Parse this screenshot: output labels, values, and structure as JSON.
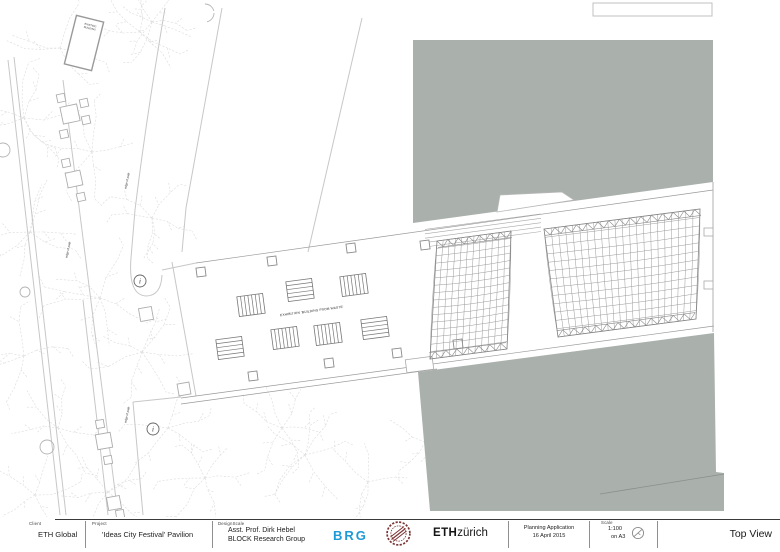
{
  "titleblock": {
    "client_label": "Client",
    "client_value": "ETH Global",
    "project_label": "Project",
    "project_value": "'Ideas City Festival' Pavilion",
    "design_label": "DesignScale",
    "design_line1": "Asst. Prof. Dirk Hebel",
    "design_line2": "BLOCK Research Group",
    "brg_logo": "BRG",
    "eth_bold": "ETH",
    "eth_light": "zürich",
    "planning_line1": "Planning Application",
    "planning_line2": "16 April 2015",
    "scale_label": "Scale",
    "scale_value": "1:100",
    "scale_sheet": "on A3",
    "view_title": "Top View"
  },
  "colors": {
    "block_gray": "#aab0ac",
    "line_light": "#c7c7c7",
    "line_mid": "#9a9a9a",
    "tree": "#dcdcdc",
    "brg_blue": "#1e9ad6",
    "stamp_red": "#7a3434"
  },
  "drawing": {
    "labels": {
      "exhibition": "EXHIBITION 'BUILDING FROM WASTE'",
      "path_label": "edge of path",
      "existing_note": [
        "EXISTING",
        "BUILDING"
      ],
      "marker_glyph": "i"
    },
    "gray_top_poly": [
      [
        413,
        40
      ],
      [
        713,
        40
      ],
      [
        713,
        182
      ],
      [
        413,
        223
      ]
    ],
    "gray_top_notch": [
      [
        497,
        212
      ],
      [
        500,
        195
      ],
      [
        562,
        192
      ],
      [
        574,
        200
      ]
    ],
    "gray_bottom_poly": [
      [
        418,
        372
      ],
      [
        714,
        333
      ],
      [
        716,
        472
      ],
      [
        724,
        473
      ],
      [
        724,
        511
      ],
      [
        430,
        511
      ]
    ],
    "bottom_diag_line": [
      [
        600,
        494
      ],
      [
        724,
        474
      ]
    ],
    "bottom_notch_rect": {
      "x": 406,
      "y": 358,
      "w": 27,
      "h": 13,
      "rot": -7.5
    },
    "topright_box": {
      "x": 593,
      "y": 3,
      "w": 119,
      "h": 13
    },
    "right_wall_line": [
      [
        713,
        182
      ],
      [
        713,
        332
      ]
    ],
    "wall_jogs": [
      [
        704,
        228,
        9,
        8
      ],
      [
        704,
        281,
        9,
        8
      ]
    ],
    "corridor_lines": [
      [
        [
          196,
          263
        ],
        [
          713,
          190
        ]
      ],
      [
        [
          181,
          398
        ],
        [
          714,
          326
        ]
      ],
      [
        [
          181,
          404
        ],
        [
          437,
          369
        ]
      ]
    ],
    "steps": {
      "x1": 425,
      "y1": 247,
      "x2": 541,
      "y2": 231.5,
      "count": 5,
      "gap": 4.4
    },
    "panels": [
      {
        "TL": [
          437,
          241
        ],
        "TR": [
          511,
          231
        ],
        "BL": [
          430,
          359
        ],
        "BR": [
          507,
          349
        ],
        "cols": 12,
        "rows": 16,
        "zz": 6.5
      },
      {
        "TL": [
          544,
          229
        ],
        "TR": [
          700,
          209
        ],
        "BL": [
          558,
          337
        ],
        "BR": [
          696,
          319
        ],
        "cols": 22,
        "rows": 13,
        "zz": 6.5
      }
    ],
    "streets": [
      [
        [
          8,
          60
        ],
        [
          60,
          515
        ]
      ],
      [
        [
          14,
          57
        ],
        [
          66,
          515
        ]
      ],
      [
        [
          63,
          80
        ],
        [
          118,
          515
        ]
      ],
      [
        [
          222,
          8
        ],
        [
          186,
          208
        ],
        [
          182,
          252
        ]
      ],
      [
        [
          362,
          18
        ],
        [
          308,
          252
        ]
      ],
      [
        [
          83,
          300
        ],
        [
          108,
          515
        ]
      ],
      [
        [
          133,
          402
        ],
        [
          143,
          515
        ]
      ],
      [
        [
          172,
          262
        ],
        [
          196,
          396
        ]
      ],
      [
        [
          133,
          402
        ],
        [
          181,
          397
        ]
      ],
      [
        [
          162,
          270
        ],
        [
          196,
          263
        ]
      ]
    ],
    "loop_path": "M165,8 Q146,120 135,210 L131,258 Q128,295 146,296 Q161,296 162,275",
    "trees": [
      [
        60,
        48,
        46,
        3
      ],
      [
        140,
        32,
        42,
        7
      ],
      [
        24,
        118,
        50,
        11
      ],
      [
        92,
        152,
        46,
        13
      ],
      [
        152,
        218,
        44,
        17
      ],
      [
        30,
        232,
        48,
        19
      ],
      [
        100,
        298,
        52,
        23
      ],
      [
        24,
        356,
        50,
        29
      ],
      [
        142,
        352,
        46,
        31
      ],
      [
        58,
        428,
        48,
        37
      ],
      [
        168,
        428,
        44,
        41
      ],
      [
        108,
        492,
        42,
        43
      ],
      [
        205,
        478,
        40,
        47
      ],
      [
        152,
        22,
        38,
        53
      ],
      [
        35,
        495,
        40,
        59
      ],
      [
        305,
        455,
        44,
        61
      ],
      [
        368,
        482,
        42,
        67
      ],
      [
        425,
        442,
        40,
        71
      ],
      [
        282,
        428,
        40,
        73
      ]
    ],
    "circles": [
      {
        "x": 25,
        "y": 292,
        "r": 5
      },
      {
        "x": 47,
        "y": 447,
        "r": 7
      },
      {
        "x": 3,
        "y": 150,
        "r": 7
      },
      {
        "x": 205,
        "y": 13,
        "r": 9,
        "partial": true
      }
    ],
    "markers": [
      {
        "x": 140,
        "y": 281
      },
      {
        "x": 153,
        "y": 429
      }
    ],
    "existing_rect": {
      "x": 84,
      "y": 43,
      "w": 28,
      "h": 50,
      "rot": 14
    },
    "site_squares": [
      {
        "x": 70,
        "y": 114,
        "s": 17,
        "rot": -12
      },
      {
        "x": 61,
        "y": 98,
        "s": 8,
        "rot": -12
      },
      {
        "x": 84,
        "y": 103,
        "s": 8,
        "rot": -12
      },
      {
        "x": 64,
        "y": 134,
        "s": 8,
        "rot": -12
      },
      {
        "x": 86,
        "y": 120,
        "s": 8,
        "rot": -12
      },
      {
        "x": 74,
        "y": 179,
        "s": 15,
        "rot": -12
      },
      {
        "x": 66,
        "y": 163,
        "s": 8,
        "rot": -12
      },
      {
        "x": 81,
        "y": 197,
        "s": 8,
        "rot": -12
      },
      {
        "x": 146,
        "y": 314,
        "s": 13,
        "rot": -10
      },
      {
        "x": 184,
        "y": 389,
        "s": 12,
        "rot": -10
      },
      {
        "x": 104,
        "y": 441,
        "s": 15,
        "rot": -10
      },
      {
        "x": 100,
        "y": 424,
        "s": 8,
        "rot": -10
      },
      {
        "x": 108,
        "y": 460,
        "s": 8,
        "rot": -10
      },
      {
        "x": 114,
        "y": 503,
        "s": 13,
        "rot": -10
      },
      {
        "x": 120,
        "y": 514,
        "s": 8,
        "rot": -10
      }
    ],
    "columns": [
      [
        201,
        272
      ],
      [
        272,
        261
      ],
      [
        351,
        248
      ],
      [
        425,
        245
      ],
      [
        253,
        376
      ],
      [
        329,
        363
      ],
      [
        397,
        353
      ],
      [
        458,
        344
      ]
    ],
    "benches": [
      {
        "x": 251,
        "y": 305,
        "o": "v"
      },
      {
        "x": 300,
        "y": 290,
        "o": "h"
      },
      {
        "x": 354,
        "y": 285,
        "o": "v"
      },
      {
        "x": 285,
        "y": 338,
        "o": "v"
      },
      {
        "x": 328,
        "y": 334,
        "o": "v"
      },
      {
        "x": 375,
        "y": 328,
        "o": "h"
      },
      {
        "x": 230,
        "y": 348,
        "o": "h"
      }
    ],
    "exhibition_pos": {
      "x": 312,
      "y": 312,
      "rot": -7.6
    },
    "path_labels": [
      {
        "x": 128,
        "y": 181,
        "rot": -78
      },
      {
        "x": 69,
        "y": 250,
        "rot": -78
      },
      {
        "x": 128,
        "y": 415,
        "rot": -78
      }
    ]
  }
}
